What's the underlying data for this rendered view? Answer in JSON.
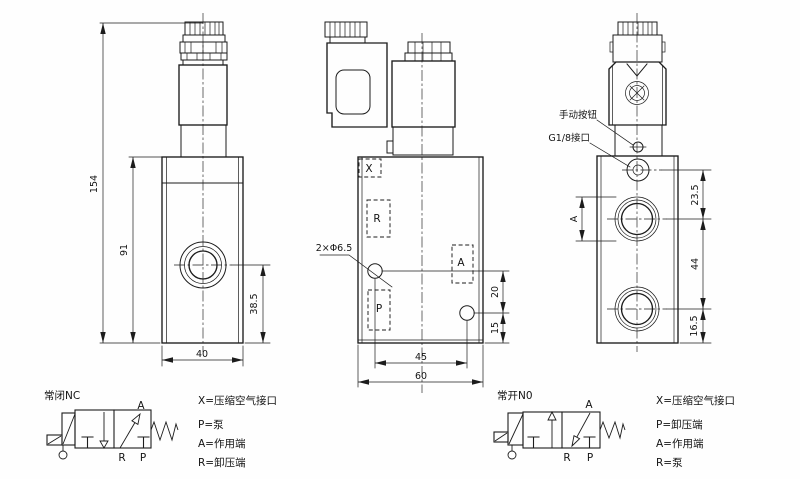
{
  "drawing": {
    "side_view": {
      "dim_overall_height": "154",
      "dim_body_height": "91",
      "dim_port_height": "38.5",
      "dim_width": "40"
    },
    "front_view": {
      "port_x": "X",
      "port_r": "R",
      "port_a": "A",
      "port_p": "P",
      "hole_callout": "2×Φ6.5",
      "dim_hole_up": "20",
      "dim_hole_bottom": "15",
      "dim_hole_spacing": "45",
      "dim_width": "60"
    },
    "right_view": {
      "callout_manual": "手动按钮",
      "callout_g18": "G1/8接口",
      "dim_port_a": "A",
      "dim_top": "23.5",
      "dim_port_spacing": "44",
      "dim_bottom": "16.5"
    },
    "nc": {
      "title": "常闭NC",
      "label_a": "A",
      "label_r": "R",
      "label_p": "P",
      "legend": [
        "X=压缩空气接口",
        "P=泵",
        "A=作用端",
        "R=卸压端"
      ]
    },
    "no": {
      "title": "常开N0",
      "label_a": "A",
      "label_r": "R",
      "label_p": "P",
      "legend": [
        "X=压缩空气接口",
        "P=卸压端",
        "A=作用端",
        "R=泵"
      ]
    }
  }
}
